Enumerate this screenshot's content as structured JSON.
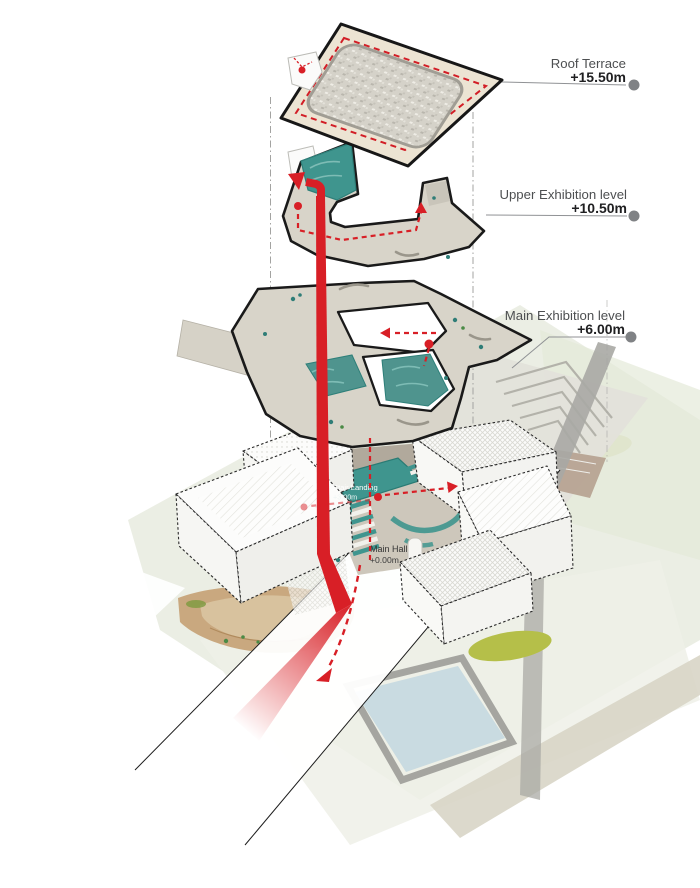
{
  "diagram": {
    "kind": "exploded-axonometric-architecture-diagram",
    "level_callouts": [
      {
        "name": "Roof Terrace",
        "elevation": "+15.50m"
      },
      {
        "name": "Upper Exhibition level",
        "elevation": "+10.50m"
      },
      {
        "name": "Main Exhibition level",
        "elevation": "+6.00m"
      }
    ],
    "floor_labels": [
      {
        "name": "Stair Landing",
        "elevation": "+3.00m"
      },
      {
        "name": "Main Hall",
        "elevation": "+0.00m"
      }
    ],
    "colors": {
      "circulation_red": "#d81f26",
      "water_teal": "#3f958e",
      "water_teal_deep": "#2e7f79",
      "roof_plate": "#ece4d3",
      "floor_plate": "#d8d4c9",
      "callout_dot": "#808285",
      "pool_blue": "#c9dbe1",
      "lawn_olive": "#b5bf49",
      "site_green": "#e9ece1",
      "sand_tan": "#c9a87f",
      "outline_black": "#1a1a1a"
    }
  }
}
